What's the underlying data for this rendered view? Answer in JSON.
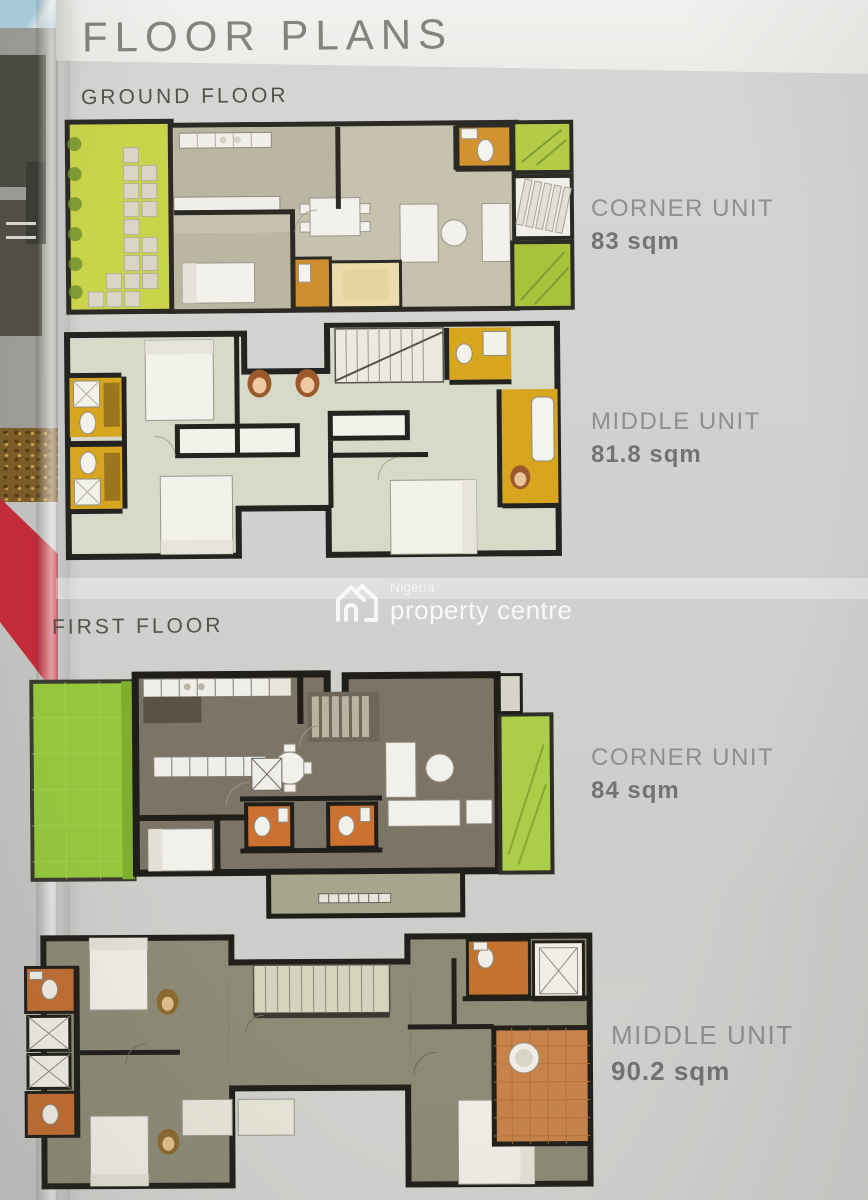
{
  "page": {
    "title": "FLOOR PLANS",
    "sections": [
      {
        "label": "GROUND FLOOR",
        "units": [
          {
            "name": "CORNER UNIT",
            "area": "83 sqm"
          },
          {
            "name": "MIDDLE UNIT",
            "area": "81.8 sqm"
          }
        ]
      },
      {
        "label": "FIRST FLOOR",
        "units": [
          {
            "name": "CORNER UNIT",
            "area": "84 sqm"
          },
          {
            "name": "MIDDLE UNIT",
            "area": "90.2 sqm"
          }
        ]
      }
    ]
  },
  "watermark": {
    "brand_top": "Nigeria",
    "brand_bottom": "property centre"
  },
  "colors": {
    "garden_green": "#c9d44b",
    "lawn_green": "#96c83d",
    "bath_amber": "#d8a51e",
    "bath_orange": "#cc7130",
    "terracotta": "#c8834b",
    "wall_dark": "#26251f",
    "adjacent_page_red": "#c62b3a",
    "header_band": "#f0f0ee",
    "page_gray": "#d0d2d0"
  }
}
